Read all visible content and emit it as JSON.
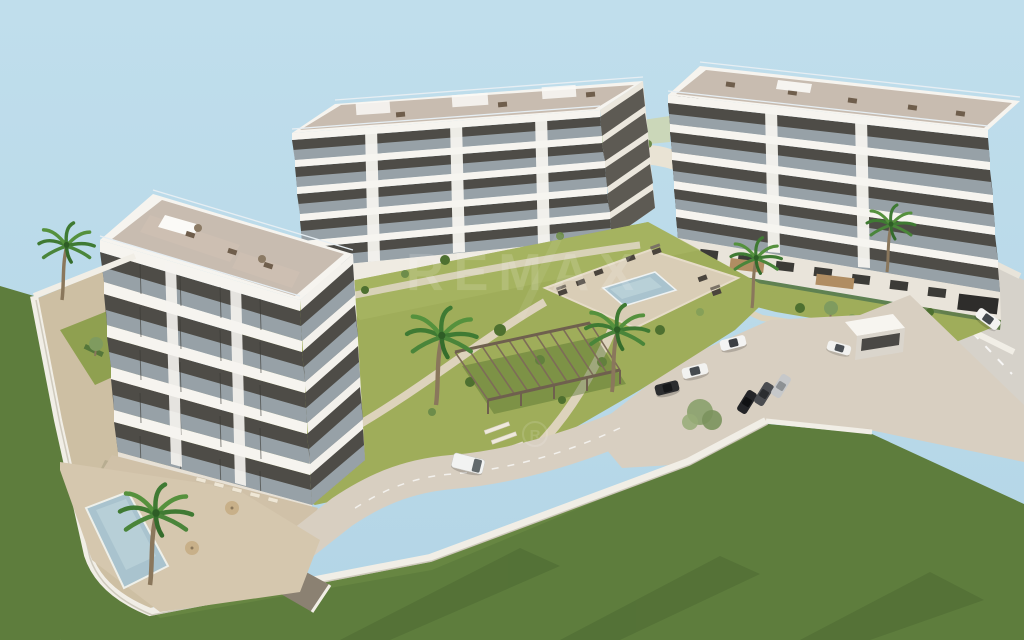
{
  "meta": {
    "title": "Aerial 3D architectural rendering of a residential apartment complex",
    "scene_type": "real-estate development visualization",
    "view": "aerial three-quarter view, daytime, clear pale-blue sky"
  },
  "watermark": {
    "brand": "REMAX",
    "roundel_letter": "R"
  },
  "palette": {
    "sky": "#b9d9e8",
    "building_white": "#f6f4ef",
    "building_shade": "#e9e5db",
    "balcony_recess": "#4e4c47",
    "balcony_glass": "#b7c6d0",
    "roof_deck": "#c8bcb0",
    "lawn_bright": "#9fad5a",
    "lawn_dark": "#5e7d3d",
    "pavement": "#d8cfc1",
    "road_public": "#d6d2ca",
    "deck_sand": "#d5c7ae",
    "pool_water": "#a9c3ce",
    "wall_white": "#f1eee6",
    "pergola_wood": "#7d6c58",
    "palm_green": "#3f7a33",
    "earth_tan": "#cdbfa3"
  },
  "scene": {
    "buildings": [
      {
        "id": "left-building",
        "position": "left foreground",
        "floors": 5,
        "features": [
          "glass balconies",
          "rooftop terraces with furniture",
          "ground-floor garden terraces with parasols",
          "underground garage ramp"
        ]
      },
      {
        "id": "center-building",
        "position": "center background",
        "floors": 5,
        "features": [
          "continuous balconies",
          "rooftop pergola frames",
          "white facade piers",
          "podium with wooden deck terraces"
        ]
      },
      {
        "id": "right-building",
        "position": "right background",
        "floors": 5,
        "features": [
          "glass balconies",
          "stepped rooftop terraces",
          "street-level base with hedges"
        ]
      }
    ],
    "amenities": {
      "communal_pool": {
        "location": "central courtyard deck",
        "loungers": 7
      },
      "private_pool": {
        "location": "bottom-left walled garden",
        "loungers": 5
      },
      "pergola": {
        "location": "central lawn",
        "bays": 5
      },
      "entrance_kiosk": {
        "location": "parking entrance near public road"
      }
    },
    "vegetation": {
      "palm_trees": 6,
      "shrubs_and_olive_trees": "scattered through courtyard, borders and right lawn",
      "lawn_areas": [
        "central courtyard",
        "large bottom-right field with mow stripes",
        "left border strip"
      ]
    },
    "vehicles": [
      {
        "id": "white-van",
        "color": "white",
        "location": "internal road"
      },
      {
        "id": "white-convertible",
        "color": "white",
        "location": "driveway"
      },
      {
        "id": "white-sedan",
        "color": "white",
        "location": "driveway"
      },
      {
        "id": "black-suv",
        "color": "black",
        "location": "driveway"
      },
      {
        "id": "parked-car-black",
        "color": "black",
        "location": "parking row"
      },
      {
        "id": "parked-car-grey",
        "color": "grey",
        "location": "parking row"
      },
      {
        "id": "parked-car-silver",
        "color": "silver",
        "location": "parking row"
      },
      {
        "id": "white-car-gate",
        "color": "white",
        "location": "entrance gate"
      },
      {
        "id": "white-car-road",
        "color": "white",
        "location": "public road"
      }
    ],
    "infrastructure": {
      "perimeter_wall": "white rendered wall enclosing the plot",
      "internal_road": "curved access road with dashed centre line and garage ramp",
      "public_road": "street along right edge with lamps and sidewalk",
      "street_lamps": 3,
      "parking_area": "paved forecourt with parked cars",
      "paths": "sand-coloured walkways and garden steps"
    }
  }
}
